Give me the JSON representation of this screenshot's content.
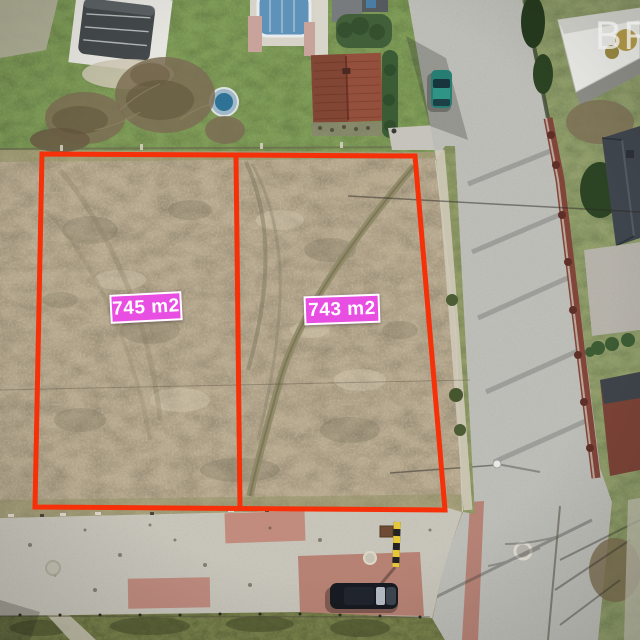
{
  "page": {
    "type": "aerial-drone-photo-of-building-plots"
  },
  "watermark": {
    "text": "BR"
  },
  "annotations": {
    "outline_color": "#f63008",
    "label_background_color": "#e94ee3",
    "label_text_color": "#ffffff",
    "plots": [
      {
        "area_label": "745 m2"
      },
      {
        "area_label": "743 m2"
      }
    ]
  },
  "scene": {
    "objects": [
      "vacant-plots-field",
      "plot-boundary-outline",
      "plot-divider-line",
      "pool-enclosure-left",
      "round-pool",
      "pool-enclosure-top",
      "red-roof-house",
      "hedges",
      "bare-trees",
      "street",
      "teal-parked-car",
      "brick-fence",
      "white-roof-structure",
      "dark-roof-house",
      "sidewalk",
      "pink-pavers",
      "dark-parked-car",
      "speed-bollard",
      "manhole-covers",
      "power-line",
      "street-lamp"
    ]
  }
}
